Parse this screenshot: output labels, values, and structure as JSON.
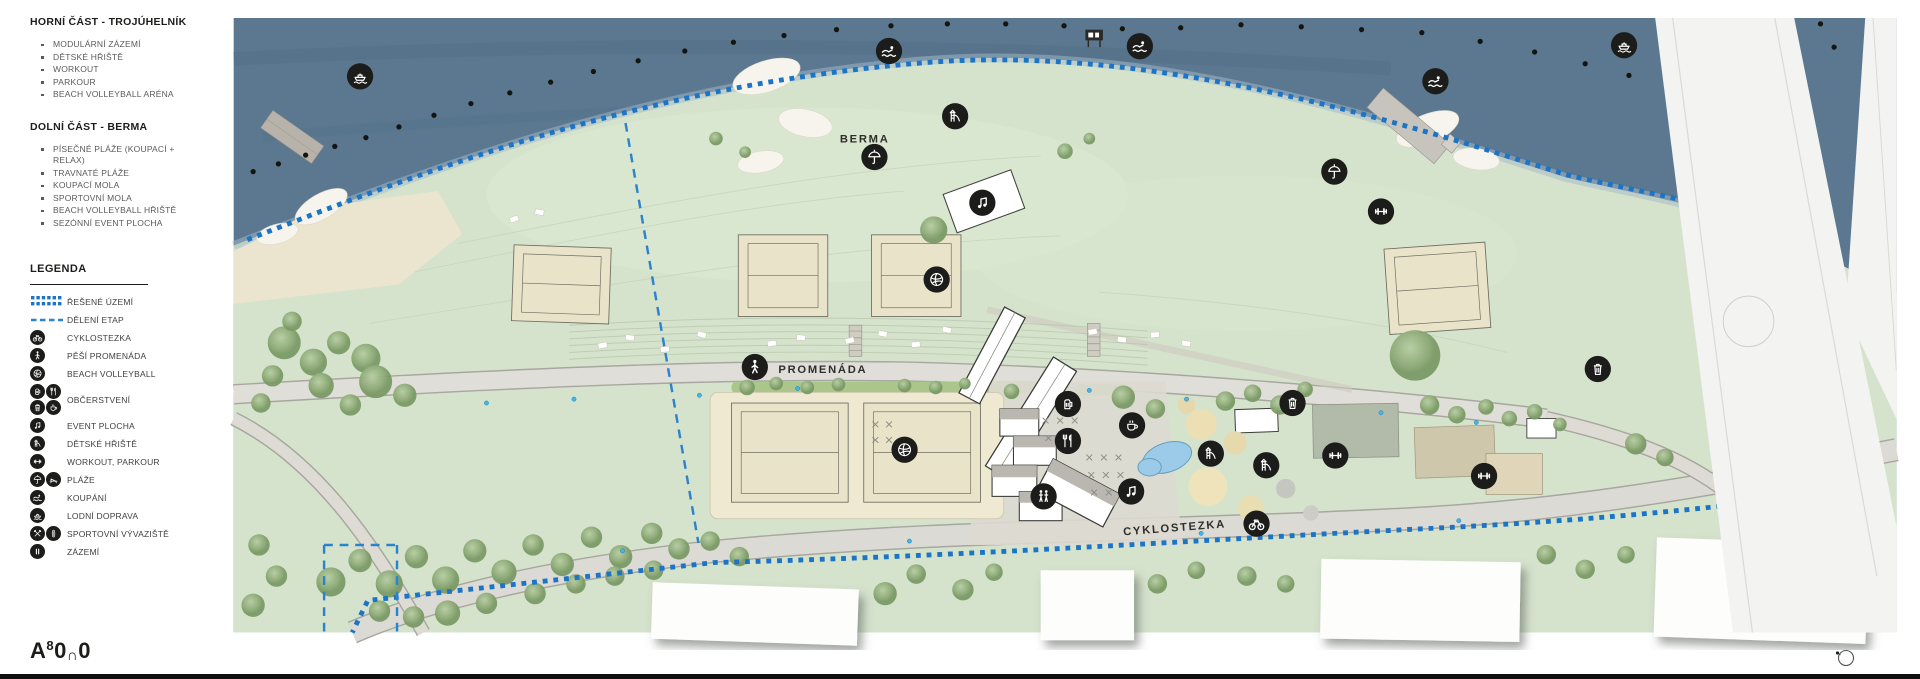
{
  "sidebar": {
    "section1": {
      "title": "HORNÍ ČÁST - TROJÚHELNÍK",
      "items": [
        "MODULÁRNÍ ZÁZEMÍ",
        "DĚTSKÉ HŘIŠTĚ",
        "WORKOUT",
        "PARKOUR",
        "BEACH VOLLEYBALL ARÉNA"
      ]
    },
    "section2": {
      "title": "DOLNÍ ČÁST - BERMA",
      "items": [
        "PÍSEČNÉ PLÁŽE (KOUPACÍ + RELAX)",
        "TRAVNATÉ PLÁŽE",
        "KOUPACÍ MOLA",
        "SPORTOVNÍ MOLA",
        "BEACH VOLLEYBALL HŘIŠTĚ",
        "SEZÓNNÍ EVENT PLOCHA"
      ]
    },
    "legend": {
      "title": "LEGENDA",
      "items": [
        {
          "swatch": "dotted-area-swatch",
          "label": "ŘEŠENÉ ÚZEMÍ"
        },
        {
          "swatch": "dashed-line-swatch",
          "label": "DĚLENÍ ETAP"
        },
        {
          "icons": [
            "bike-icon"
          ],
          "label": "CYKLOSTEZKA"
        },
        {
          "icons": [
            "pedestrian-icon"
          ],
          "label": "PĚŠÍ PROMENÁDA"
        },
        {
          "icons": [
            "volleyball-icon"
          ],
          "label": "BEACH VOLLEYBALL"
        },
        {
          "icons": [
            "beer-icon",
            "utensils-icon",
            "trash-icon",
            "coffee-icon"
          ],
          "label": "OBČERSTVENÍ"
        },
        {
          "icons": [
            "music-icon"
          ],
          "label": "EVENT PLOCHA"
        },
        {
          "icons": [
            "slide-icon"
          ],
          "label": "DĚTSKÉ HŘIŠTĚ"
        },
        {
          "icons": [
            "workout-icon"
          ],
          "label": "WORKOUT, PARKOUR"
        },
        {
          "icons": [
            "umbrella-icon",
            "lounger-icon"
          ],
          "label": "PLÁŽE"
        },
        {
          "icons": [
            "swimmer-icon"
          ],
          "label": "KOUPÁNÍ"
        },
        {
          "icons": [
            "boat-icon"
          ],
          "label": "LODNÍ DOPRAVA"
        },
        {
          "icons": [
            "paddles-icon",
            "board-icon"
          ],
          "label": "SPORTOVNÍ VÝVAZIŠTĚ"
        },
        {
          "icons": [
            "facilities-icon"
          ],
          "label": "ZÁZEMÍ"
        }
      ]
    }
  },
  "map": {
    "labels": [
      {
        "text": "BERMA",
        "x": 859,
        "y": 146,
        "rot": 0
      },
      {
        "text": "PROMENÁDA",
        "x": 816,
        "y": 383,
        "rot": 0
      },
      {
        "text": "CYKLOSTEZKA",
        "x": 1178,
        "y": 546,
        "rot": -4.5
      }
    ],
    "markers": [
      {
        "icon": "boat-icon",
        "x": 340,
        "y": 78
      },
      {
        "icon": "swimmer-icon",
        "x": 884,
        "y": 52
      },
      {
        "icon": "swimmer-icon",
        "x": 1142,
        "y": 47
      },
      {
        "icon": "swimmer-icon",
        "x": 1446,
        "y": 83
      },
      {
        "icon": "boat-icon",
        "x": 1640,
        "y": 46
      },
      {
        "icon": "slide-icon",
        "x": 952,
        "y": 119
      },
      {
        "icon": "umbrella-icon",
        "x": 869,
        "y": 161
      },
      {
        "icon": "music-icon",
        "x": 980,
        "y": 208
      },
      {
        "icon": "umbrella-icon",
        "x": 1342,
        "y": 176
      },
      {
        "icon": "workout-icon",
        "x": 1390,
        "y": 217
      },
      {
        "icon": "volleyball-icon",
        "x": 933,
        "y": 287
      },
      {
        "icon": "pedestrian-icon",
        "x": 746,
        "y": 377
      },
      {
        "icon": "beer-icon",
        "x": 1068,
        "y": 415
      },
      {
        "icon": "trash-icon",
        "x": 1299,
        "y": 414
      },
      {
        "icon": "coffee-icon",
        "x": 1134,
        "y": 437
      },
      {
        "icon": "utensils-icon",
        "x": 1068,
        "y": 453
      },
      {
        "icon": "volleyball-icon",
        "x": 900,
        "y": 462
      },
      {
        "icon": "slide-icon",
        "x": 1215,
        "y": 466
      },
      {
        "icon": "slide-icon",
        "x": 1272,
        "y": 478
      },
      {
        "icon": "workout-icon",
        "x": 1343,
        "y": 468
      },
      {
        "icon": "workout-icon",
        "x": 1496,
        "y": 489
      },
      {
        "icon": "wc-icon",
        "x": 1043,
        "y": 510
      },
      {
        "icon": "music-icon",
        "x": 1133,
        "y": 505
      },
      {
        "icon": "bike-icon",
        "x": 1262,
        "y": 538
      },
      {
        "icon": "trash-icon",
        "x": 1613,
        "y": 379
      }
    ],
    "colors": {
      "water": "#5b7890",
      "land": "#d5e3cd",
      "boundary_blue": "#1b74c5",
      "etap_blue": "#2b83cc",
      "icon_bg": "#1c1c1a",
      "court_sand": "#e9e3c9",
      "road": "#dedbd5"
    }
  },
  "logo": {
    "text": "A8000",
    "parts": [
      {
        "char": "A",
        "style": "l-a"
      },
      {
        "char": "8",
        "style": "l-sup"
      },
      {
        "char": "0",
        "style": "l-o"
      },
      {
        "char": "∩",
        "style": "l-sub"
      },
      {
        "char": "0",
        "style": "l-o"
      }
    ]
  }
}
